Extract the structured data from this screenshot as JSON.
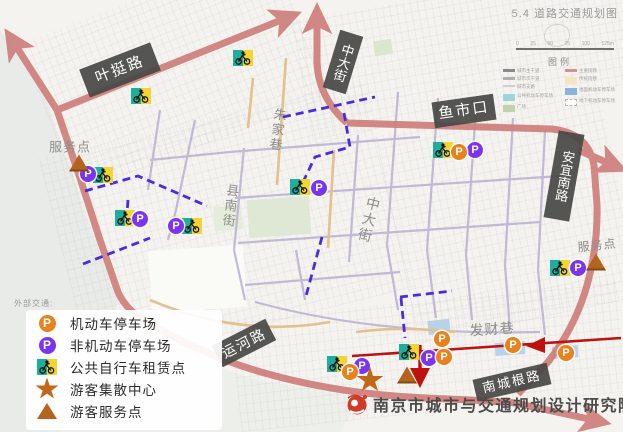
{
  "title": "5.4 道路交通规划图",
  "scale_bar": {
    "ticks": [
      "0",
      "25",
      "50",
      "75",
      "100",
      "125m"
    ],
    "legend_label": "图例"
  },
  "mini_legend": {
    "left": [
      {
        "sw": "ln1",
        "label": "城市主干道"
      },
      {
        "sw": "ln2",
        "label": "城市次干道"
      },
      {
        "sw": "ln3",
        "label": "城市支路"
      },
      {
        "sw": "bx-teal",
        "label": "公共机动车停车场"
      },
      {
        "sw": "bx-green",
        "label": "广场"
      }
    ],
    "right": [
      {
        "sw": "ln-pink",
        "label": "主要街巷"
      },
      {
        "sw": "bx-yellow",
        "label": "传统街巷"
      },
      {
        "sw": "bx-blue",
        "label": "地面机动车停车场"
      },
      {
        "sw": "bx-dash",
        "label": "地下机动车停车场"
      }
    ]
  },
  "external_legend": {
    "header": "外部交通:",
    "items": [
      {
        "icon": "p-orange",
        "label": "机动车停车场"
      },
      {
        "icon": "p-purple",
        "label": "非机动车停车场"
      },
      {
        "icon": "bike",
        "label": "公共自行车租赁点"
      },
      {
        "icon": "star",
        "label": "游客集散中心"
      },
      {
        "icon": "triangle",
        "label": "游客服务点"
      }
    ]
  },
  "footer": {
    "org": "南京市城市与交通规划设计研究院"
  },
  "map": {
    "road_labels": [
      {
        "text": "叶挺路",
        "x": 120,
        "y": 70,
        "rot": -21,
        "vert": false,
        "fs": 15,
        "w": 76,
        "h": 30
      },
      {
        "text": "中大街",
        "x": 343,
        "y": 62,
        "rot": 17,
        "vert": true,
        "fs": 13,
        "w": 24,
        "h": 60
      },
      {
        "text": "鱼市口",
        "x": 464,
        "y": 111,
        "rot": -8,
        "vert": false,
        "fs": 15,
        "w": 62,
        "h": 26
      },
      {
        "text": "安宜南路",
        "x": 564,
        "y": 176,
        "rot": 10,
        "vert": true,
        "fs": 13,
        "w": 26,
        "h": 88
      },
      {
        "text": "运河路",
        "x": 244,
        "y": 343,
        "rot": -27,
        "vert": false,
        "fs": 14,
        "w": 60,
        "h": 24
      },
      {
        "text": "南城根路",
        "x": 512,
        "y": 382,
        "rot": -13,
        "vert": false,
        "fs": 13,
        "w": 76,
        "h": 22
      }
    ],
    "street_names": [
      {
        "text": "朱家巷",
        "x": 277,
        "y": 130,
        "rot": 8,
        "vert": true,
        "fs": 13
      },
      {
        "text": "县南街",
        "x": 230,
        "y": 206,
        "rot": 7,
        "vert": true,
        "fs": 13
      },
      {
        "text": "中大街",
        "x": 369,
        "y": 220,
        "rot": 14,
        "vert": true,
        "fs": 14
      },
      {
        "text": "发财巷",
        "x": 492,
        "y": 329,
        "rot": -4,
        "vert": false,
        "fs": 14
      },
      {
        "text": "服务点",
        "x": 70,
        "y": 146,
        "rot": 0,
        "vert": false,
        "fs": 13
      },
      {
        "text": "服务点",
        "x": 597,
        "y": 245,
        "rot": -6,
        "vert": false,
        "fs": 12
      }
    ],
    "markers": [
      {
        "type": "bike",
        "x": 243,
        "y": 58
      },
      {
        "type": "bike",
        "x": 141,
        "y": 96
      },
      {
        "type": "bike",
        "x": 103,
        "y": 175
      },
      {
        "type": "bike",
        "x": 125,
        "y": 218
      },
      {
        "type": "bike",
        "x": 192,
        "y": 226
      },
      {
        "type": "bike",
        "x": 300,
        "y": 187
      },
      {
        "type": "bike",
        "x": 443,
        "y": 150
      },
      {
        "type": "bike",
        "x": 560,
        "y": 268
      },
      {
        "type": "bike",
        "x": 337,
        "y": 364
      },
      {
        "type": "bike",
        "x": 409,
        "y": 352
      },
      {
        "type": "p-purple",
        "x": 88,
        "y": 174
      },
      {
        "type": "p-purple",
        "x": 140,
        "y": 219
      },
      {
        "type": "p-purple",
        "x": 176,
        "y": 226
      },
      {
        "type": "p-purple",
        "x": 319,
        "y": 188
      },
      {
        "type": "p-purple",
        "x": 475,
        "y": 150
      },
      {
        "type": "p-purple",
        "x": 578,
        "y": 268
      },
      {
        "type": "p-purple",
        "x": 362,
        "y": 366
      },
      {
        "type": "p-purple",
        "x": 429,
        "y": 358
      },
      {
        "type": "p-orange",
        "x": 459,
        "y": 152
      },
      {
        "type": "p-orange",
        "x": 350,
        "y": 372
      },
      {
        "type": "p-orange",
        "x": 444,
        "y": 357
      },
      {
        "type": "p-orange",
        "x": 442,
        "y": 339
      },
      {
        "type": "p-orange",
        "x": 513,
        "y": 345
      },
      {
        "type": "p-orange",
        "x": 566,
        "y": 353
      },
      {
        "type": "star",
        "x": 370,
        "y": 380
      },
      {
        "type": "triangle",
        "x": 79,
        "y": 163
      },
      {
        "type": "triangle",
        "x": 596,
        "y": 262
      },
      {
        "type": "triangle",
        "x": 407,
        "y": 375
      }
    ]
  },
  "colors": {
    "arterial_pink": "#cf7f7b",
    "one_way_red": "#bd1210",
    "slow_route_purple": "#4a2be0",
    "minor_road": "#b6abd1",
    "lane_tan": "#e2c18d",
    "p_orange": "#e8821e",
    "p_purple": "#7b35ee",
    "bike_teal": "#1fae9e",
    "bike_yellow": "#f3d430",
    "tourist_brown": "#b4641e",
    "label_box": "#484846"
  }
}
